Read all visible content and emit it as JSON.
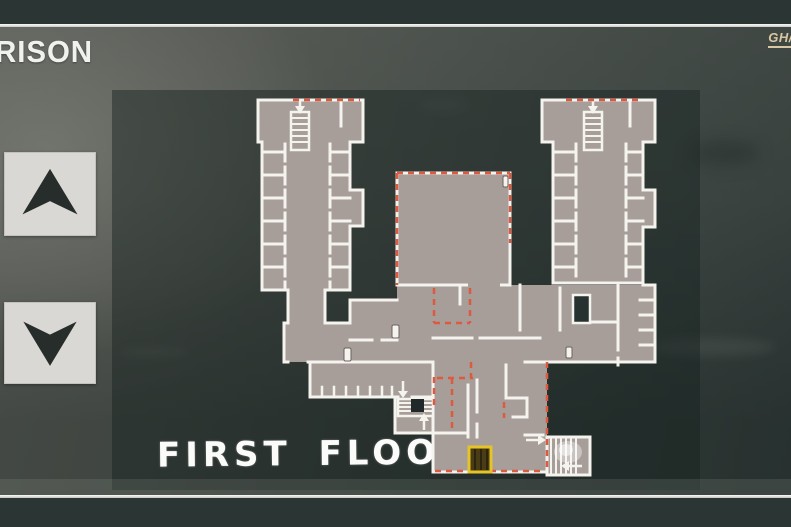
{
  "header": {
    "title": "RISON",
    "watermark": "GH//"
  },
  "map": {
    "floor_label": "FIRST FLOOR",
    "markers": {
      "highlighted_exit": "yellow-highlighted-door",
      "staircases": [
        "left-block-staircase",
        "right-block-staircase",
        "central-staircase",
        "southeast-staircase"
      ],
      "security_lines": "red-dashed-doors"
    }
  },
  "controls": {
    "floor_up_icon": "up-arrow-icon",
    "floor_down_icon": "down-arrow-icon"
  },
  "colors": {
    "top_bar": "#2b3634",
    "separator_line": "#f1f2ee",
    "wall_background": "#53564f",
    "map_panel": "#273432",
    "floor_fill": "#a79e99",
    "map_walls": "#f5f3ee",
    "red_dashes": "#dd5a41",
    "exit_highlight": "#e3bd25",
    "watermark_tan": "#d8c9a2",
    "button_face": "#d9d8d4",
    "button_arrow": "#272d2b",
    "title_text": "#f1f1ee",
    "floor_label_text": "#fbfbf9"
  }
}
